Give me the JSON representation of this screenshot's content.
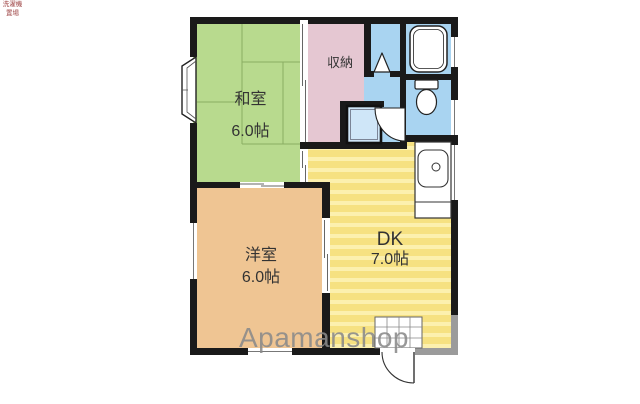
{
  "floorplan": {
    "watermark": "Apamanshop",
    "rooms": {
      "washitsu": {
        "name": "和室",
        "size": "6.0帖"
      },
      "closet": {
        "name": "収納"
      },
      "western": {
        "name": "洋室",
        "size": "6.0帖"
      },
      "dk": {
        "name": "DK",
        "size": "7.0帖"
      },
      "laundry": {
        "name": "洗濯機置場"
      }
    },
    "fixtures": {
      "bathtub": "bathtub-icon",
      "toilet": "toilet-icon",
      "kitchen_sink": "kitchen-sink-icon",
      "bay_window": "bay-window-icon",
      "entrance_tiles": "genkan-tile-icon",
      "entrance_door": "entrance-door-icon",
      "folding_door": "folding-door-icon",
      "interior_door": "interior-door-icon"
    },
    "colors": {
      "wall": "#1a1a1a",
      "wall_gray": "#9b9b9b",
      "tatami_green": "#b8da8e",
      "storage_pink": "#e5c7d2",
      "water_blue": "#a9d4f1",
      "dk_yellow": "#f6e181",
      "dk_stripe": "#fcf0ae",
      "western_tan": "#efc593",
      "fixture_blue": "#cfe6f8",
      "tatami_line": "#8aad63",
      "label_text": "#333333",
      "laundry_text": "#9c4040",
      "watermark_gray": "#8a8a8a"
    }
  }
}
